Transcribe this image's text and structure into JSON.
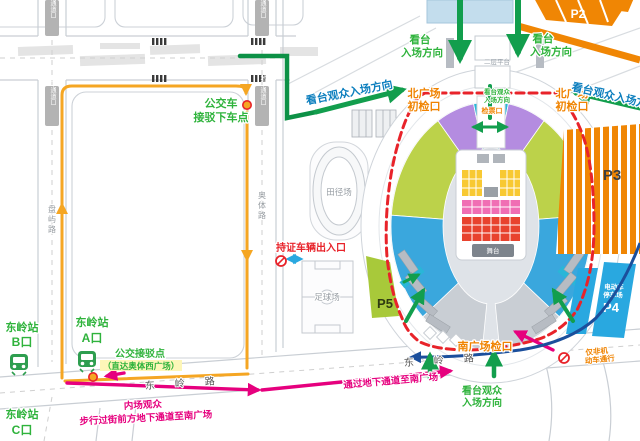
{
  "palette": {
    "green_arrow": "#129e4d",
    "green_text": "#2fb33c",
    "orange": "#f08300",
    "orange_route": "#f5a623",
    "red": "#e8232a",
    "magenta": "#e6007e",
    "navy": "#1b4f9c",
    "cyan": "#29b6d8",
    "blue_seat": "#3aa7dd",
    "purple_seat": "#b48ce0",
    "lime_seat": "#bcd24a",
    "yellow_floor": "#f8c932",
    "pink_floor": "#f06eb4",
    "red_floor": "#e8432e",
    "p4_blue": "#29a8e0",
    "p5_green": "#a8c93a"
  },
  "roads": {
    "dongling": "东岭路",
    "panyu": "盘屿路",
    "aoti": "奥体路",
    "underpass_portal": "地下通道口"
  },
  "station": {
    "name": "东岭站",
    "exit_a": "A口",
    "exit_b": "B口",
    "exit_c": "C口"
  },
  "green": {
    "bus_dropoff_l1": "公交车",
    "bus_dropoff_l2": "接驳下车点",
    "shuttle_point": "公交接驳点",
    "shuttle_sub": "（直达奥体西广场）",
    "stand_l1": "看台",
    "stand_l2": "入场方向",
    "stand_flow": "看台观众入场方向",
    "gate_small_l1": "看台观众",
    "gate_small_l2": "入场方向",
    "south_l1": "看台观众",
    "south_l2": "入场方向"
  },
  "orange_labels": {
    "north_check_l1": "北广场",
    "north_check_l2": "初检口",
    "ticket_gate": "检票口",
    "south_check": "南广场检口",
    "nonmotor_l1": "仅非机",
    "nonmotor_l2": "动车通行"
  },
  "red_labels": {
    "permit_gate": "持证车辆出入口"
  },
  "magenta_labels": {
    "infield_l1": "内场观众",
    "infield_l2": "步行过街前方地下通道至南广场",
    "underpass_south": "通过地下通道至南广场"
  },
  "venues": {
    "track": "田径场",
    "soccer": "足球场",
    "platform2": "二层平台",
    "stage": "舞台"
  },
  "parking": {
    "p2": "P2",
    "p3": "P3",
    "p4_l1": "电动车",
    "p4_l2": "停车场",
    "p4": "P4",
    "p5": "P5"
  }
}
